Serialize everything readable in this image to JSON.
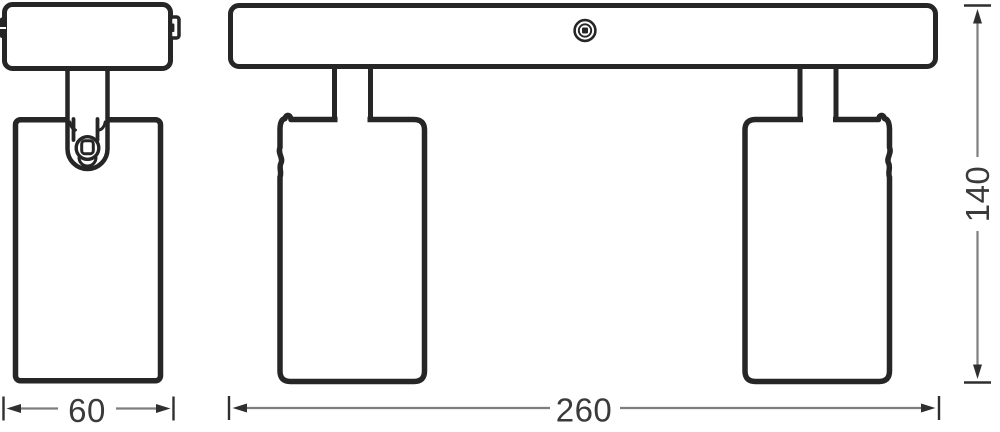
{
  "diagram_title": "spotlight-fixture-dimension-drawing",
  "dims": {
    "spot_width": "60",
    "bar_width": "260",
    "height": "140"
  },
  "icons": {
    "mounting_screw": "screw-head-icon",
    "pivot_screw": "pivot-screw-icon"
  },
  "colors": {
    "outline": "#262626",
    "dim_line": "#7e7e7e",
    "dim_marks": "#2f2f2f",
    "dim_text": "#3a3a3a",
    "background": "#ffffff"
  }
}
